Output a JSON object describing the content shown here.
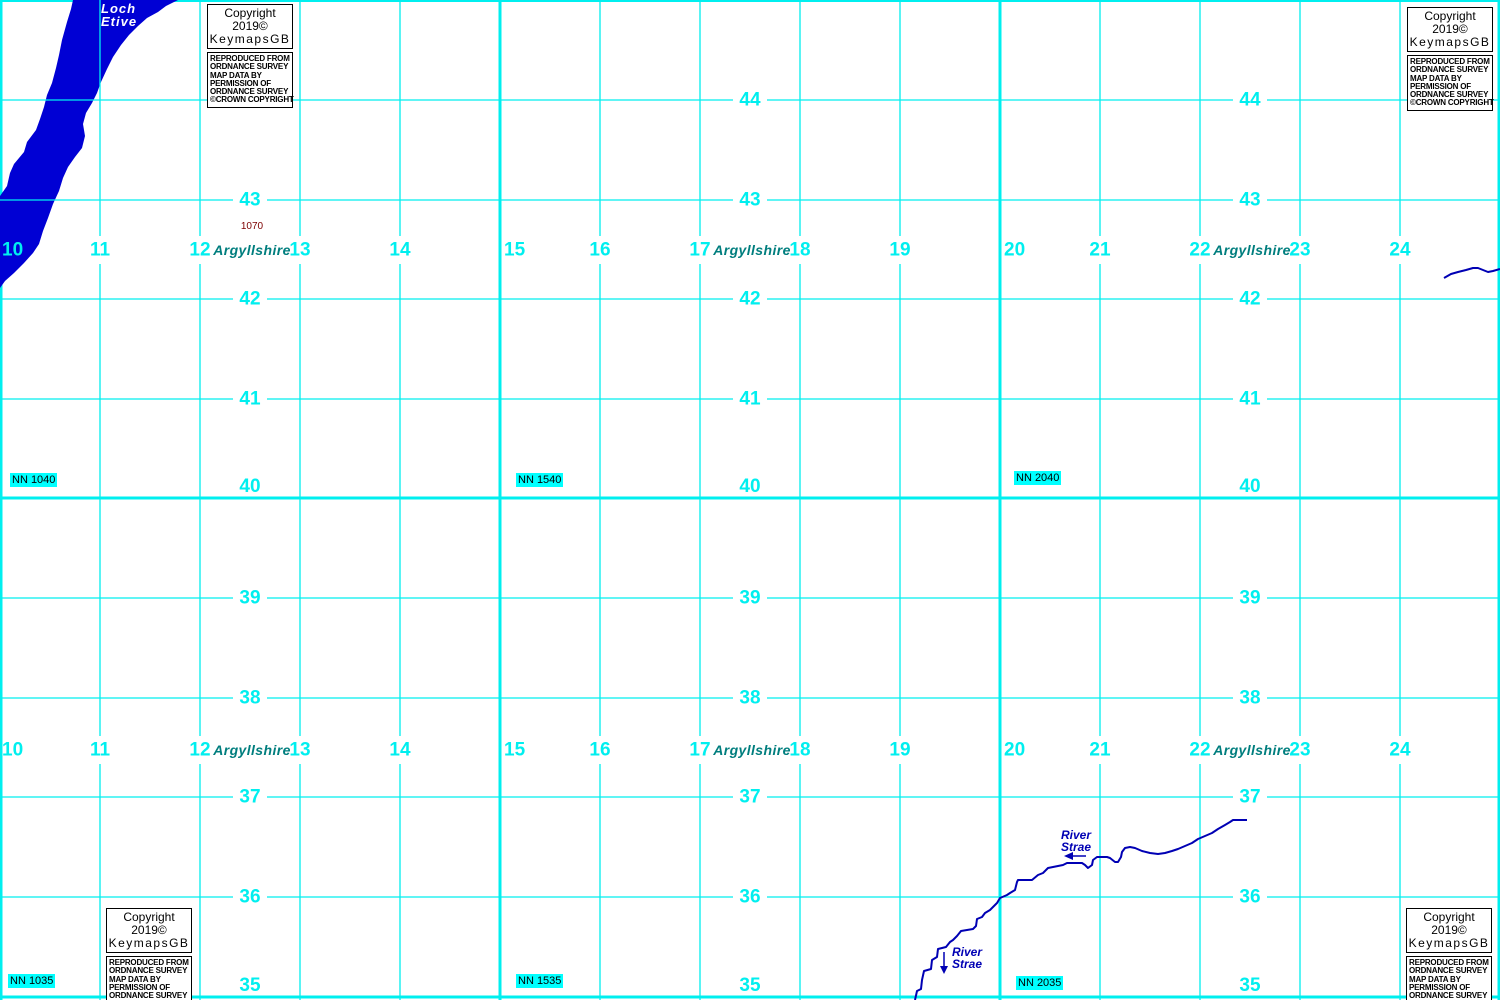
{
  "colors": {
    "grid": "#00efef",
    "water": "#0000d4",
    "river": "#0000b4",
    "county": "#007e7e",
    "spot": "#7d0000",
    "nn_background": "#00ffff",
    "text": "#000000"
  },
  "grid": {
    "col_label_y": [
      250,
      750
    ],
    "row_label_x": [
      250,
      750,
      1250
    ],
    "columns": [
      {
        "value": "10",
        "x": 0
      },
      {
        "value": "11",
        "x": 100
      },
      {
        "value": "12",
        "x": 200
      },
      {
        "value": "13",
        "x": 300
      },
      {
        "value": "14",
        "x": 400
      },
      {
        "value": "15",
        "x": 500
      },
      {
        "value": "16",
        "x": 600
      },
      {
        "value": "17",
        "x": 700
      },
      {
        "value": "18",
        "x": 800
      },
      {
        "value": "19",
        "x": 900
      },
      {
        "value": "20",
        "x": 1000
      },
      {
        "value": "21",
        "x": 1100
      },
      {
        "value": "22",
        "x": 1200
      },
      {
        "value": "23",
        "x": 1300
      },
      {
        "value": "24",
        "x": 1400
      }
    ],
    "rows": [
      {
        "value": "44",
        "y": 100
      },
      {
        "value": "43",
        "y": 200
      },
      {
        "value": "42",
        "y": 299
      },
      {
        "value": "41",
        "y": 399
      },
      {
        "value": "40",
        "y": 498
      },
      {
        "value": "39",
        "y": 598
      },
      {
        "value": "38",
        "y": 698
      },
      {
        "value": "37",
        "y": 797
      },
      {
        "value": "36",
        "y": 897
      },
      {
        "value": "35",
        "y": 997
      }
    ]
  },
  "labels": {
    "loch": [
      "Loch",
      "Etive"
    ],
    "county": "Argyllshire",
    "county_positions": [
      {
        "x": 252,
        "y": 250
      },
      {
        "x": 752,
        "y": 250
      },
      {
        "x": 1252,
        "y": 250
      },
      {
        "x": 252,
        "y": 750
      },
      {
        "x": 752,
        "y": 750
      },
      {
        "x": 1252,
        "y": 750
      }
    ],
    "river": [
      "River",
      "Strae"
    ],
    "river_positions": [
      {
        "x": 1076,
        "y": 829,
        "align": "center"
      },
      {
        "x": 952,
        "y": 946,
        "align": "left"
      }
    ],
    "spot_height": "1070",
    "spot_position": {
      "x": 252,
      "y": 227
    },
    "nn_refs": [
      {
        "text": "NN 1040",
        "x": 10,
        "y": 473
      },
      {
        "text": "NN 1540",
        "x": 516,
        "y": 473
      },
      {
        "text": "NN 2040",
        "x": 1014,
        "y": 471
      },
      {
        "text": "NN 1035",
        "x": 8,
        "y": 974
      },
      {
        "text": "NN 1535",
        "x": 516,
        "y": 974
      },
      {
        "text": "NN 2035",
        "x": 1016,
        "y": 976
      }
    ]
  },
  "copyright": {
    "line1": "Copyright 2019©",
    "line2": "KeymapsGB",
    "small": [
      "REPRODUCED FROM",
      "ORDNANCE SURVEY",
      "MAP DATA BY",
      "PERMISSION OF",
      "ORDNANCE SURVEY",
      "©CROWN COPYRIGHT"
    ],
    "positions": [
      {
        "x": 207,
        "y": 4
      },
      {
        "x": 1407,
        "y": 7
      },
      {
        "x": 106,
        "y": 908
      },
      {
        "x": 1406,
        "y": 908
      }
    ]
  },
  "water": {
    "loch_polygon": "73,0 178,0 166,6 158,12 147,18 138,26 129,35 121,45 113,57 107,69 101,82 97,93 92,103 86,113 83,124 85,136 82,148 75,157 68,167 63,178 59,191 53,204 48,218 43,231 39,244 33,253 24,263 14,273 5,281 0,288 0,196 7,186 10,173 14,164 24,152 27,142 36,130 40,119 44,107 47,95 52,83 56,68 59,55 62,40 67,22 71,9",
    "river_path": "915,1000 917,991 921,989 922,980 924,971 931,969 932,960 937,957 938,949 946,947 950,942 953,940 957,936 961,931 973,929 976,926 977,919 982,917 985,913 990,910 993,907 997,903 1000,898 1007,895 1010,893 1015,890 1017,882 1018,880 1032,880 1038,875 1043,873 1048,868 1053,867 1063,865 1067,863 1082,863 1085,865 1088,868 1092,865 1093,860 1097,857 1107,857 1110,858 1115,862 1118,862 1121,857 1122,852 1125,848 1130,847 1135,848 1142,851 1150,853 1158,854 1165,853 1172,851 1178,849 1185,846 1192,843 1198,839 1205,836 1212,833 1218,829 1225,825 1230,822 1233,820 1247,820",
    "stream_path": "1444,278 1451,274 1458,272 1466,270 1473,268 1478,268 1483,270 1488,272 1493,271 1500,269",
    "flow_arrows": [
      {
        "dir": "left",
        "x": 1086,
        "y": 856,
        "len": 18
      },
      {
        "dir": "down",
        "x": 944,
        "y": 952,
        "len": 16
      }
    ]
  }
}
